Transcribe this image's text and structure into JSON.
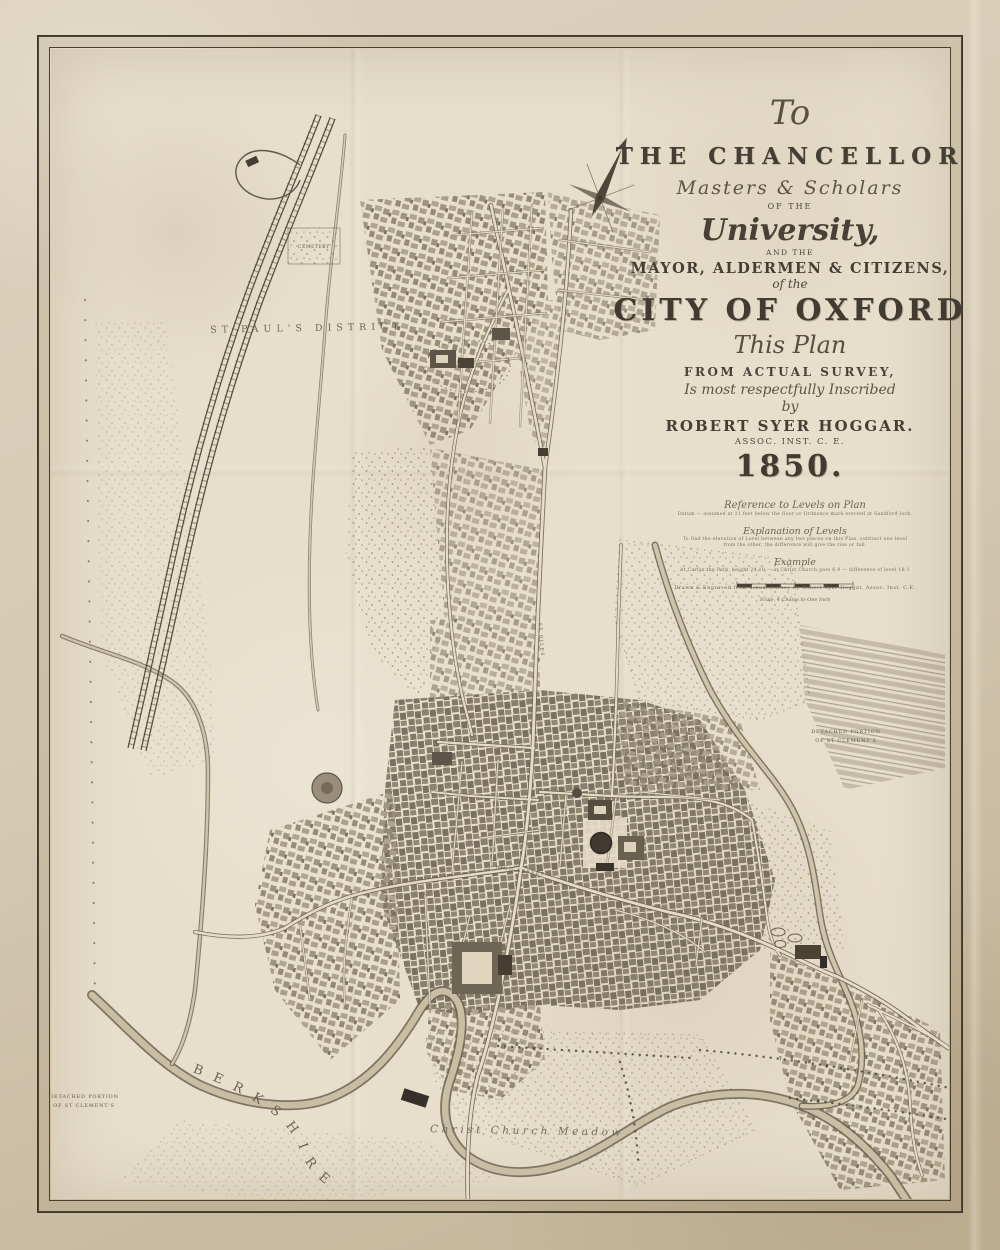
{
  "artifact": {
    "kind": "antique-town-plan",
    "city": "Oxford",
    "year": "1850",
    "surveyor": "Robert Syer Hoggar"
  },
  "palette": {
    "margin_paper": "#d6cab4",
    "map_paper": "#e7decb",
    "frame_ink": "#3e382c",
    "engraving_ink": "#554d3f",
    "dark_building": "#3a342a",
    "water": "#c9bda4"
  },
  "title_block": {
    "to": "To",
    "chancellor": "THE CHANCELLOR",
    "masters_scholars": "Masters & Scholars",
    "of_the": "OF THE",
    "university": "University,",
    "and_the": "AND THE",
    "mayor_line": "MAYOR, ALDERMEN & CITIZENS,",
    "of_the_2": "of the",
    "city_of_oxford": "CITY OF OXFORD",
    "this_plan": "This Plan",
    "from_survey": "FROM ACTUAL SURVEY,",
    "inscribed": "Is most respectfully Inscribed",
    "by": "by",
    "author": "ROBERT SYER HOGGAR.",
    "assoc": "ASSOC. INST. C. E.",
    "year": "1850."
  },
  "reference_block": {
    "ref_title": "Reference to Levels on Plan",
    "ref_line": "Datum — assumed at 11 feet below the floor or Ordnance mark erected at Sandford lock.",
    "expl_title": "Explanation of Levels",
    "expl_line1": "To find the elevation of Level between any two places on this Plan, subtract one level",
    "expl_line2": "from the other, the difference will give the rise or fall.",
    "example_title": "Example",
    "example_line": "At Carfax the Path, height 24.10 — at Christ Church gate 6.9 — difference of level 18.1",
    "imprint": "Drawn & Engraved from actual Survey by Robert Syer Hoggar, Assoc. Inst. C.E.",
    "scale_label": "Scale, 4 Chains to One Inch"
  },
  "map_labels": {
    "st_pauls_district": "ST PAUL'S DISTRICT",
    "berkshire": "B E R K S H I R E",
    "christ_church_meadow": "Christ Church Meadow",
    "detached_portion_line1": "DETACHED PORTION",
    "detached_portion_line2": "OF ST CLEMENT'S",
    "high_street": "HIGH STREET",
    "st_giles": "ST GILES",
    "cemetery": "CEMETERY"
  }
}
